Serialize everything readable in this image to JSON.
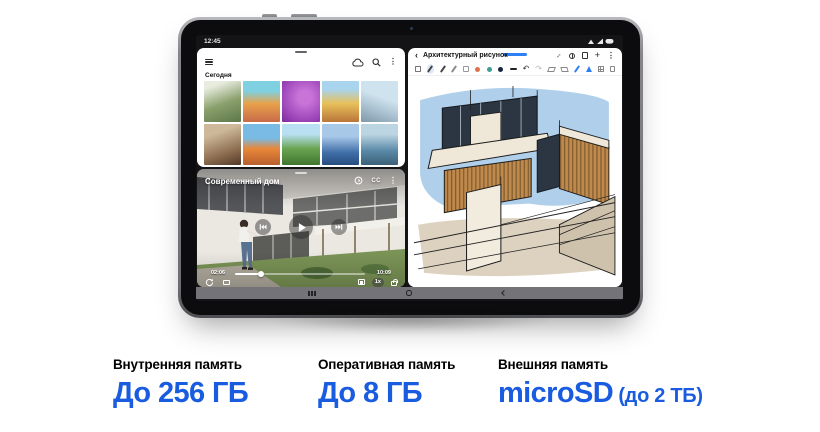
{
  "theme": {
    "accent": "#1a5ce0",
    "handle_blue": "#2d7ff5"
  },
  "tablet": {
    "statusbar": {
      "time": "12:45"
    },
    "gallery": {
      "section_label": "Сегодня",
      "more_icon": "⋮"
    },
    "video": {
      "title": "Современный дом",
      "cc_label": "CC",
      "more_icon": "⋮",
      "current_time": "02:06",
      "total_time": "10:09",
      "speed_label": "1x"
    },
    "notes": {
      "back_icon": "‹",
      "title": "Архитектурный рисунок",
      "expand_icon": "↔",
      "add_icon": "+",
      "more_icon": "⋮",
      "undo_icon": "↶",
      "redo_icon": "↷"
    }
  },
  "specs": {
    "items": [
      {
        "label": "Внутренняя память",
        "value": "До 256 ГБ",
        "suffix": ""
      },
      {
        "label": "Оперативная память",
        "value": "До 8 ГБ",
        "suffix": ""
      },
      {
        "label": "Внешняя память",
        "value": "microSD",
        "suffix": " (до 2 ТБ)"
      }
    ]
  }
}
